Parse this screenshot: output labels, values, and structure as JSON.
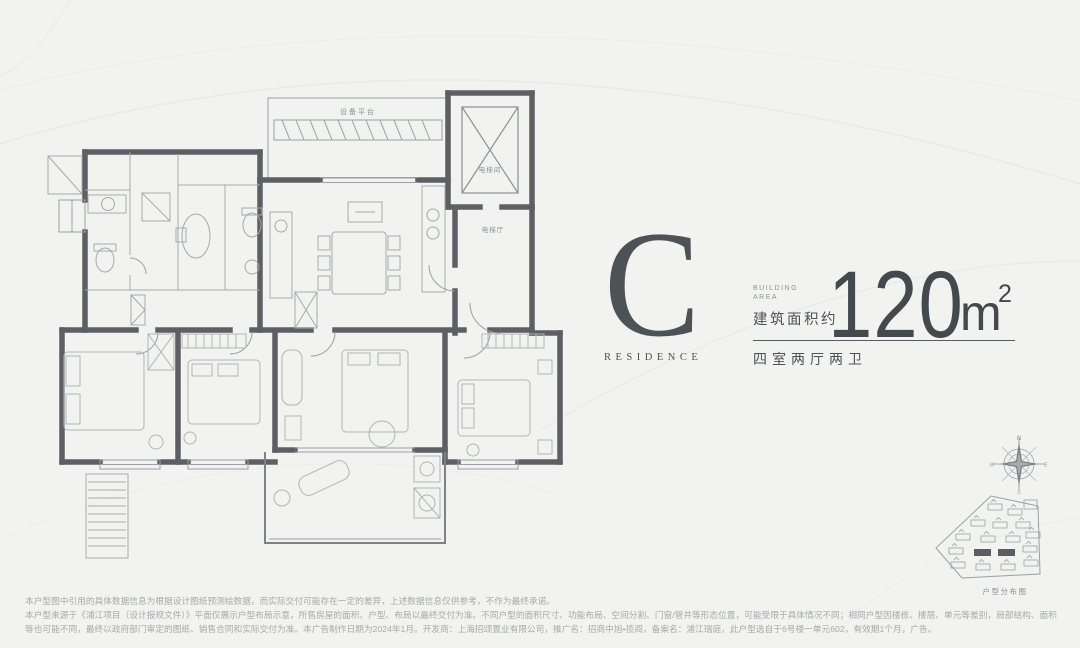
{
  "colors": {
    "background": "#f2f2f0",
    "ink": "#4d5257",
    "wall": "#5c6065",
    "thin_line": "#9aa0a6",
    "furniture_line": "#b0b4b8",
    "muted_text": "#8e9398",
    "disclaimer_text": "#a7a9ab"
  },
  "unit_info": {
    "type_letter": "C",
    "type_caption": "RESIDENCE",
    "building_area_en": "BUILDING\nAREA",
    "area_prefix": "建筑面积约",
    "area_value": "120",
    "area_unit": "m",
    "area_exponent": "2",
    "layout": "四室两厅两卫"
  },
  "floorplan": {
    "labels": {
      "equipment_platform": "设备平台",
      "elevator_room": "电梯间",
      "elevator_hall": "电梯厅"
    }
  },
  "compass": {
    "n": "N",
    "e": "E",
    "s": "S",
    "w": "W"
  },
  "siteplan": {
    "caption": "户型分布图"
  },
  "disclaimer": {
    "line1": "本户型图中引用的具体数据信息为根据设计图纸预测绘数据，而实际交付可能存在一定的差异，上述数据信息仅供参考，不作为最终承诺。",
    "line2": "本户型来源于《浦江项目（设计报规文件）》平面仅展示户型布局示意，所售房屋的面积、户型、布局以最终交付为准。不同户型的面积尺寸、功能布局、空间分割、门窗/管井等形态位置，可能受限于具体情况不同；相同户型因楼栋、楼层、单元等差别，局部结构、面积",
    "line3": "等也可能不同，最终以政府部门审定的图纸、销售合同和实际交付为准。本广告制作日期为2024年1月。开发商：上海招颂置业有限公司，推广名：招商中旭•揽阅，备案名：浦江瑞庭，此户型选自于6号楼一单元602，有效期1个月，广告。"
  }
}
